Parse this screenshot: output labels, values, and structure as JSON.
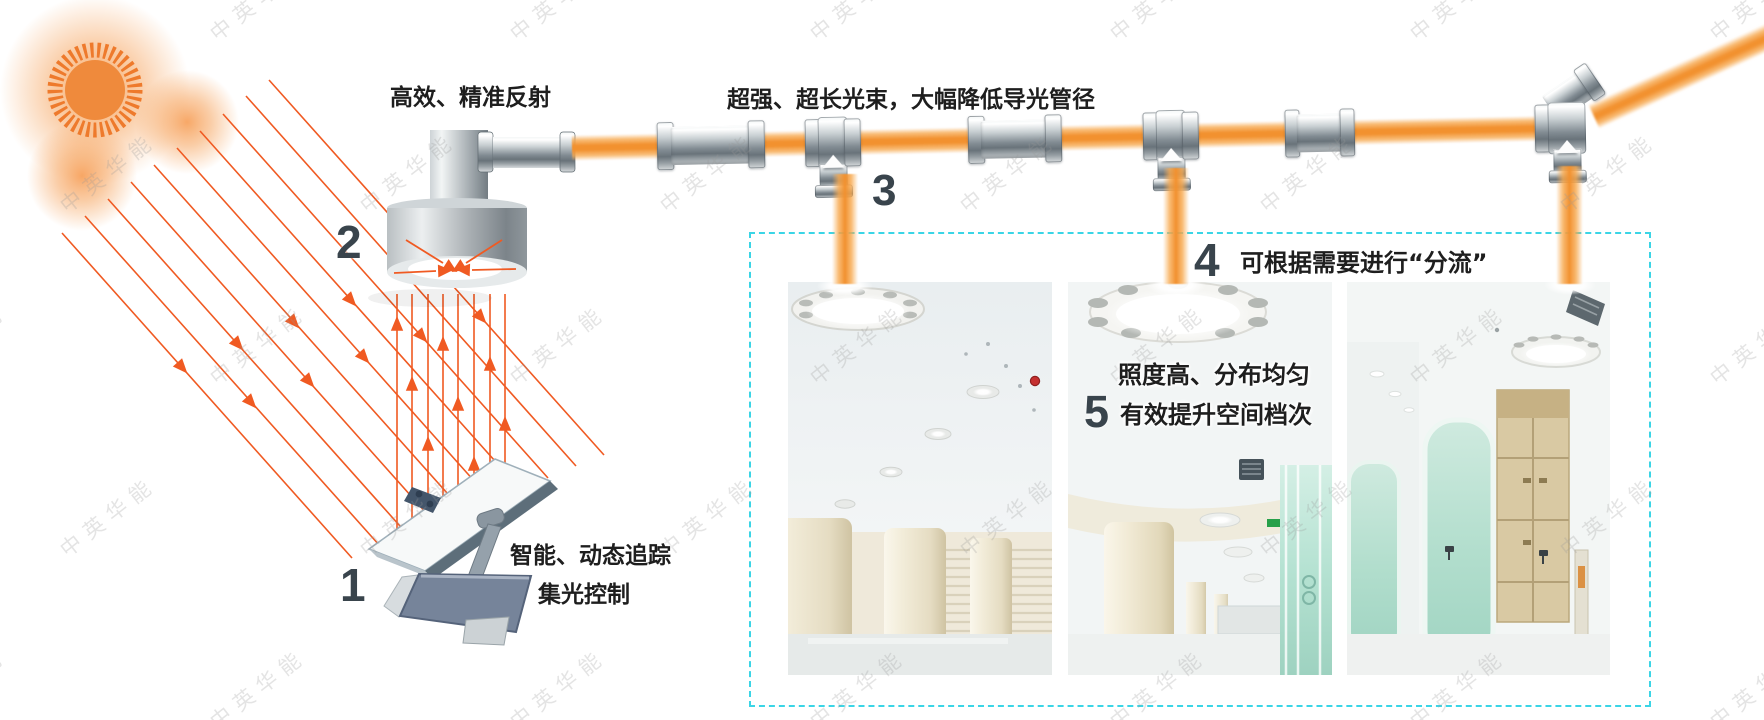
{
  "watermark": {
    "text": "中英华能"
  },
  "colors": {
    "beam_orange": "#F2912F",
    "beam_edge": "#F7A94F",
    "ray_orange": "#F05A22",
    "dashed_border": "#3BD5E6",
    "number": "#39444C",
    "label_text": "#1E1E1E",
    "watermark_gray": "#999999",
    "sun_orange": "#EF8232"
  },
  "steps": {
    "s1": {
      "num": "1",
      "line1": "智能、动态追踪",
      "line2": "集光控制"
    },
    "s2": {
      "num": "2",
      "text": "高效、精准反射"
    },
    "s3": {
      "num": "3",
      "text": "超强、超长光束，大幅降低导光管径"
    },
    "s4": {
      "num": "4",
      "text": "可根据需要进行“分流”"
    },
    "s5": {
      "num": "5",
      "line1": "照度高、分布均匀",
      "line2": "有效提升空间档次"
    }
  },
  "photos": [
    {
      "name": "lobby-with-columns-and-skylights"
    },
    {
      "name": "hall-with-large-ceiling-skylight"
    },
    {
      "name": "corridor-with-glass-walls-and-skylight"
    }
  ]
}
